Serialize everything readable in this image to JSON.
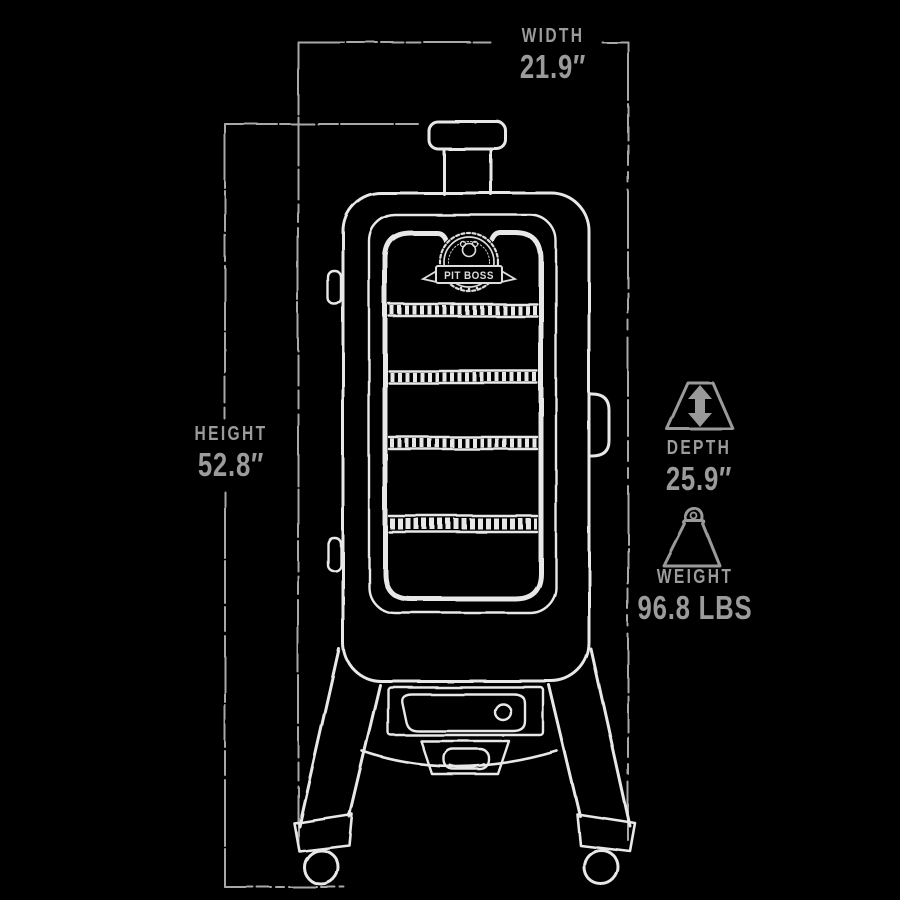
{
  "canvas": {
    "width": 900,
    "height": 900,
    "background": "#000000"
  },
  "colors": {
    "sketch_line": "#e8e8e8",
    "dimension_line": "#a8a8a8",
    "label_text": "#9b9b9b",
    "icon_gray": "#9a9a9a"
  },
  "logo": {
    "text": "PIT BOSS"
  },
  "illustration": {
    "subject": "vertical pellet smoker",
    "rack_count": 4
  },
  "dimensions": {
    "width": {
      "label": "WIDTH",
      "value": "21.9″"
    },
    "height": {
      "label": "HEIGHT",
      "value": "52.8″"
    },
    "depth": {
      "label": "DEPTH",
      "value": "25.9″",
      "icon": "depth-arrows-icon"
    },
    "weight": {
      "label": "WEIGHT",
      "value": "96.8 LBS",
      "icon": "weight-kettlebell-icon"
    }
  }
}
